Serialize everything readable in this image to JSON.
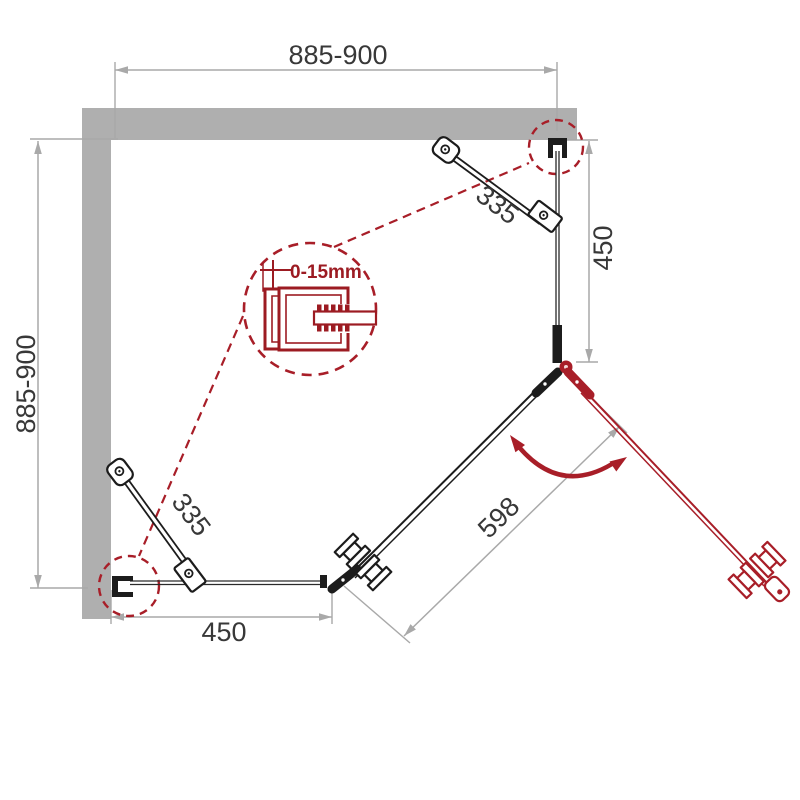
{
  "diagram": {
    "title": "Pentagonal corner shower enclosure - top view installation drawing",
    "type": "technical-dimension-drawing"
  },
  "labels": {
    "width_top": "885-900",
    "depth_left": "885-900",
    "fixed_panel_right": "450",
    "fixed_panel_bottom": "450",
    "support_bar_right": "335",
    "support_bar_left": "335",
    "door": "598",
    "profile_adjustment": "0-15mm"
  },
  "colors": {
    "wall_gray": "#afafaf",
    "dimension_gray": "#a9a9a9",
    "label_text": "#383838",
    "accent_red": "#a81e28",
    "detail_red": "#9c1b22",
    "hardware_black": "#1c1c1c"
  }
}
